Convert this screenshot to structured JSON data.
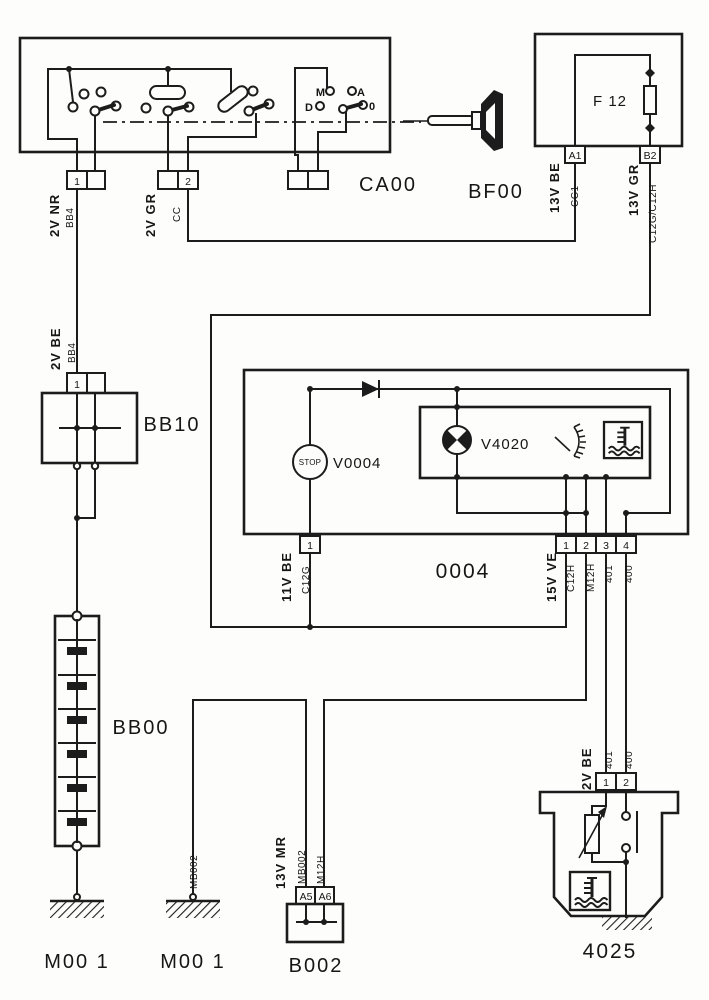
{
  "ca00": {
    "ref": "CA00",
    "pin1": "1",
    "pin2": "2",
    "pin1_label": "2V NR",
    "pin1_wire": "BB4",
    "pin2_label": "2V GR",
    "pin2_wire": "CC",
    "pos_m": "M",
    "pos_a": "A",
    "pos_d": "D",
    "pos_0": "0"
  },
  "bf00": {
    "ref": "BF00",
    "fuse": "F 12",
    "pin_a1": "A1",
    "pin_b2": "B2",
    "a1_label": "13V BE",
    "a1_wire": "CC1",
    "b2_label": "13V GR",
    "b2_wire": "C12G/C12H"
  },
  "bb10": {
    "ref": "BB10",
    "pin1": "1",
    "pin_label": "2V BE",
    "pin_wire": "BB4"
  },
  "bb00": {
    "ref": "BB00"
  },
  "cluster": {
    "ref": "0004",
    "stop": "STOP",
    "stop_ref": "V0004",
    "lamp_ref": "V4020",
    "pin_left": "1",
    "pin_left_label": "11V BE",
    "pin_left_wire": "C12G",
    "pins": [
      "1",
      "2",
      "3",
      "4"
    ],
    "pins_label": "15V VE",
    "wire1": "C12H",
    "wire2": "M12H",
    "wire3": "401",
    "wire4": "400"
  },
  "sensor": {
    "ref": "4025",
    "pin1": "1",
    "pin2": "2",
    "pin_label": "2V BE",
    "wire1": "401",
    "wire2": "400"
  },
  "b002": {
    "ref": "B002",
    "pin_a5": "A5",
    "pin_a6": "A6",
    "pin_label": "13V MR",
    "a5_wire": "MB002",
    "a6_wire": "M12H"
  },
  "grounds": {
    "g1": "M00 1",
    "g2": "M00 1",
    "g2_wire": "MB002"
  },
  "colors": {
    "ink": "#1c1c1c",
    "paper": "#fdfdfc"
  }
}
